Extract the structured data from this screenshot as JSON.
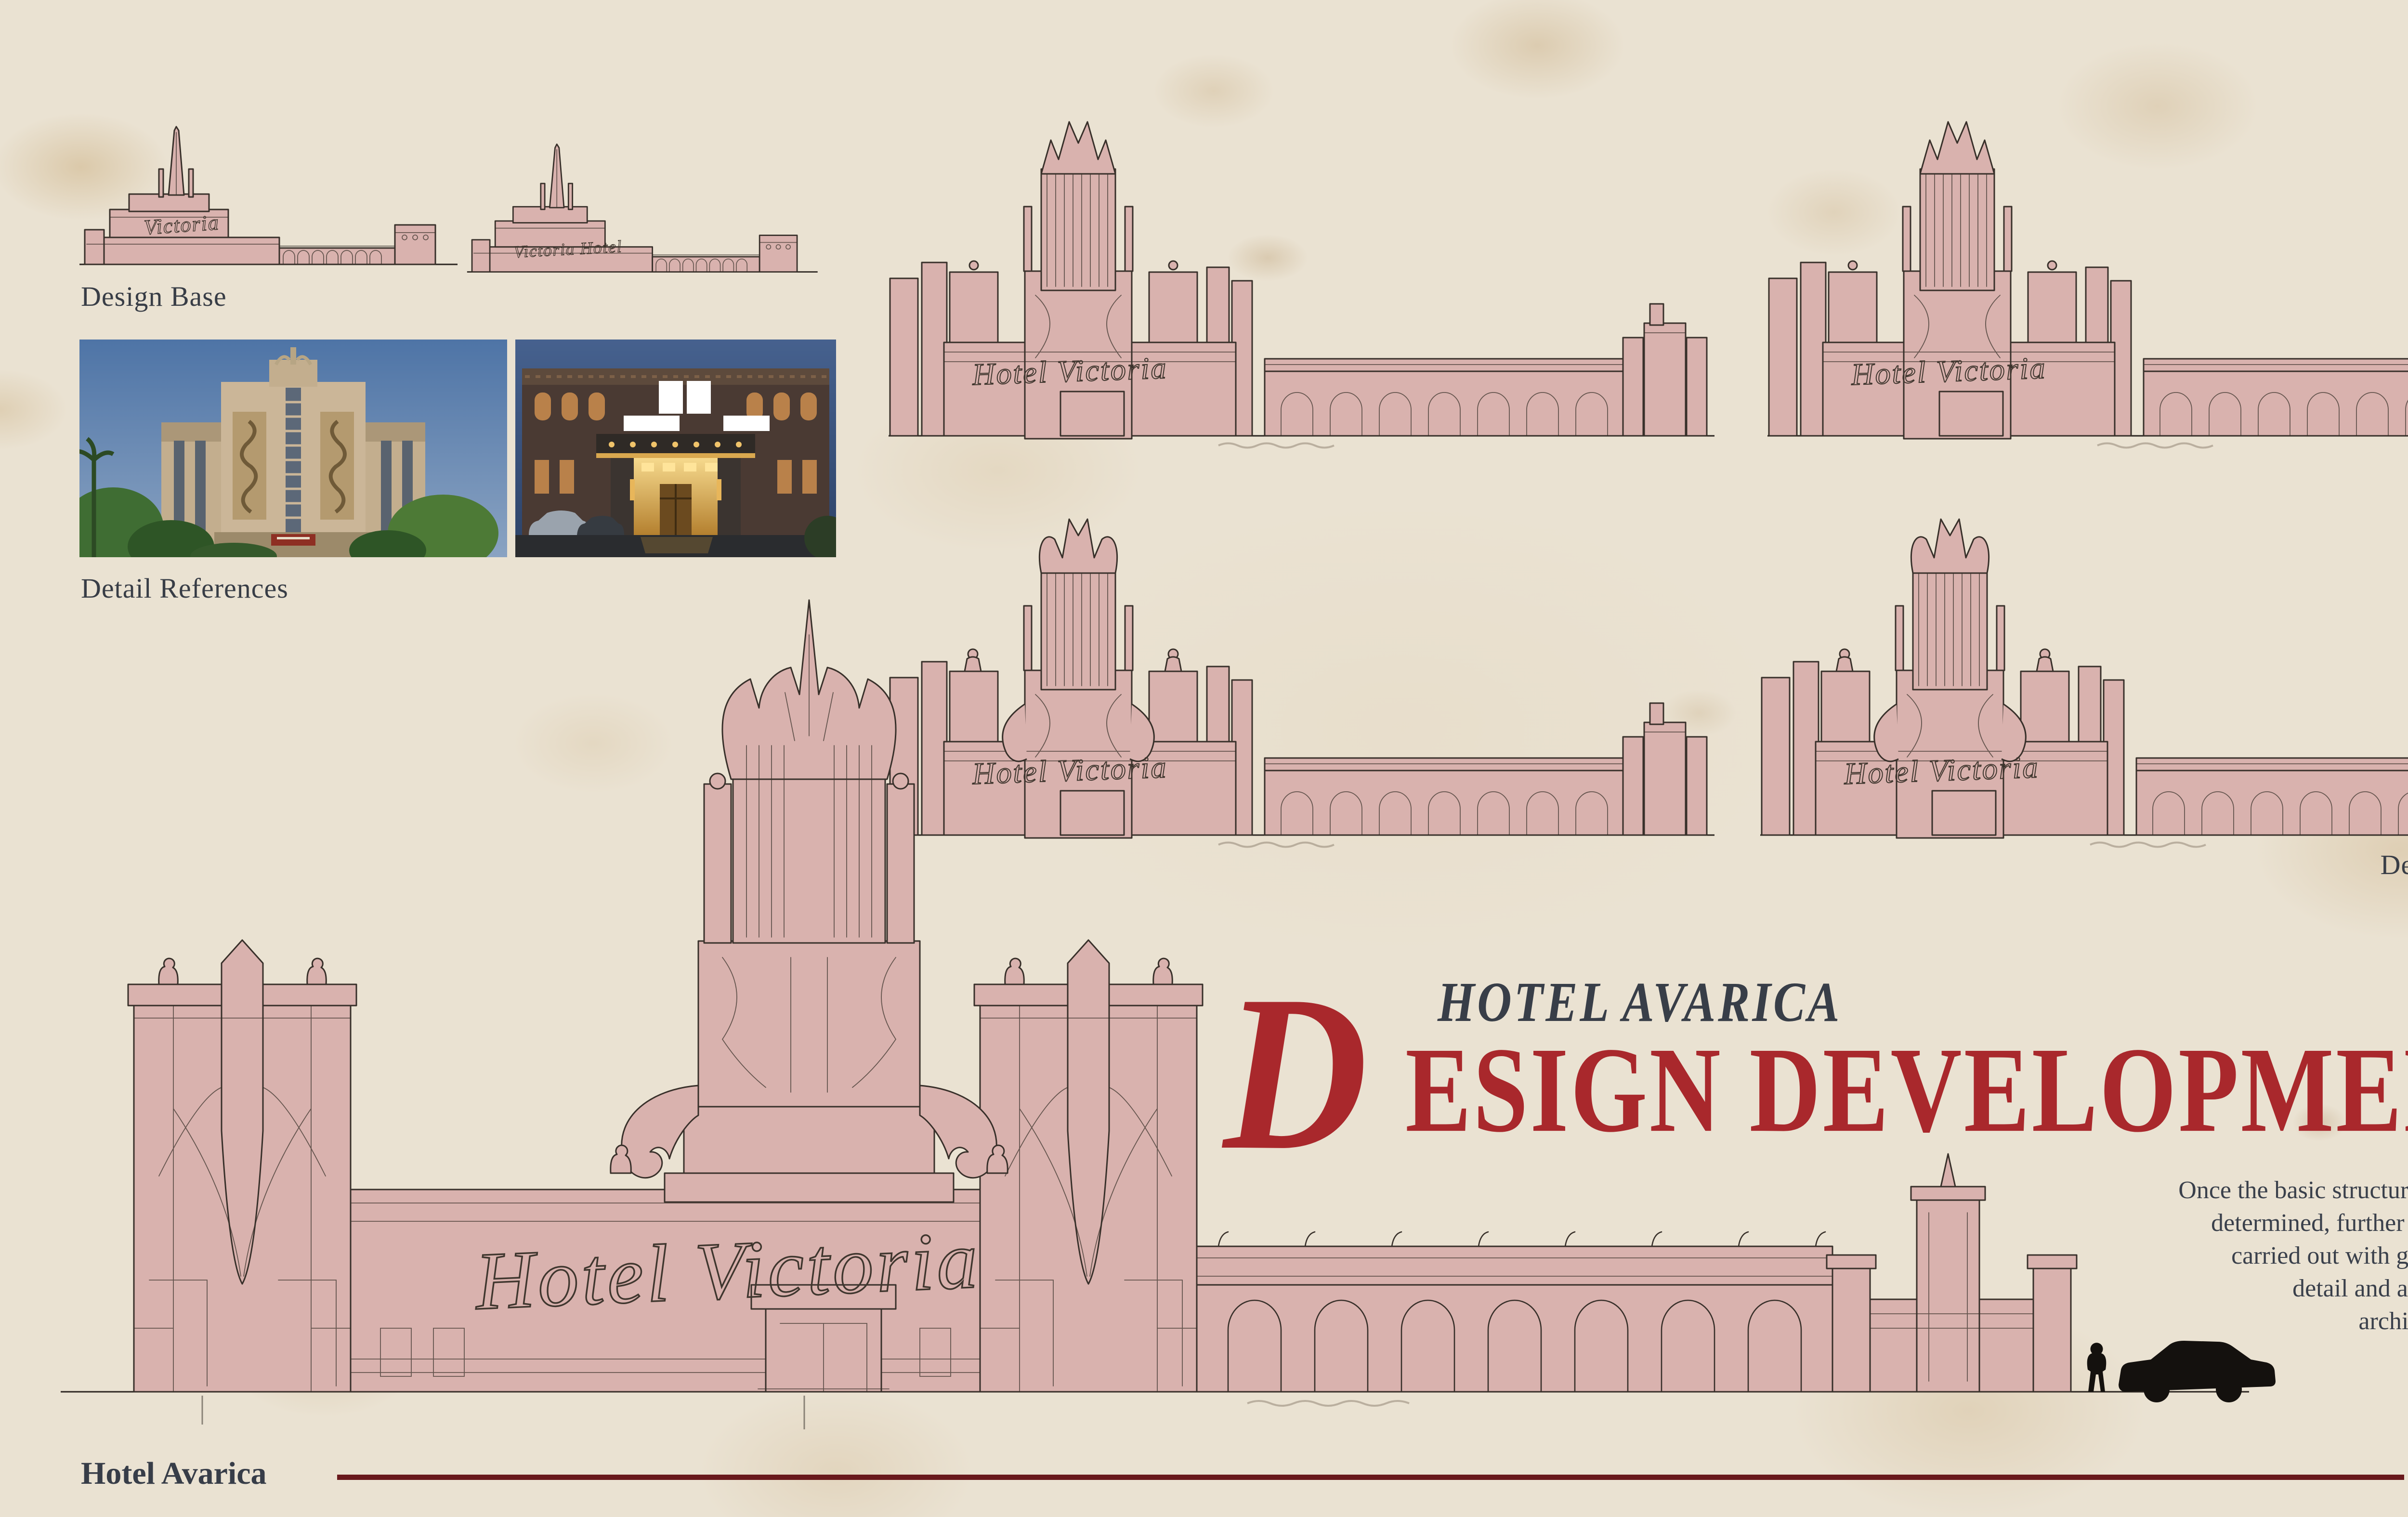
{
  "palette": {
    "paper": "#eae2d2",
    "accent_red": "#a9282c",
    "ink": "#383e48",
    "rule_maroon": "#69191c",
    "edge_strip_red": "#782420",
    "sketch_fill": "#d9b2ae",
    "sketch_line": "#38302a"
  },
  "header": {
    "kicker": "HOTEL AVARICA",
    "title_initial": "D",
    "title_rest": "ESIGN DEVELOPMENT"
  },
  "description_lines": [
    "Once the basic structure of the hotel was",
    "determined, further development was",
    "carried out with greater attention to",
    "detail and a focus on realistic",
    "architectural elements."
  ],
  "sections": {
    "design_base": "Design Base",
    "detail_references": "Detail References",
    "detail_variations": "Detail Variations"
  },
  "signs": {
    "main": "Hotel Victoria",
    "variation": "Hotel Victoria",
    "base_left": "Victoria",
    "base_right": "Victoria Hotel"
  },
  "footer": {
    "left": "Hotel Avarica",
    "right": "Daeun Min"
  }
}
